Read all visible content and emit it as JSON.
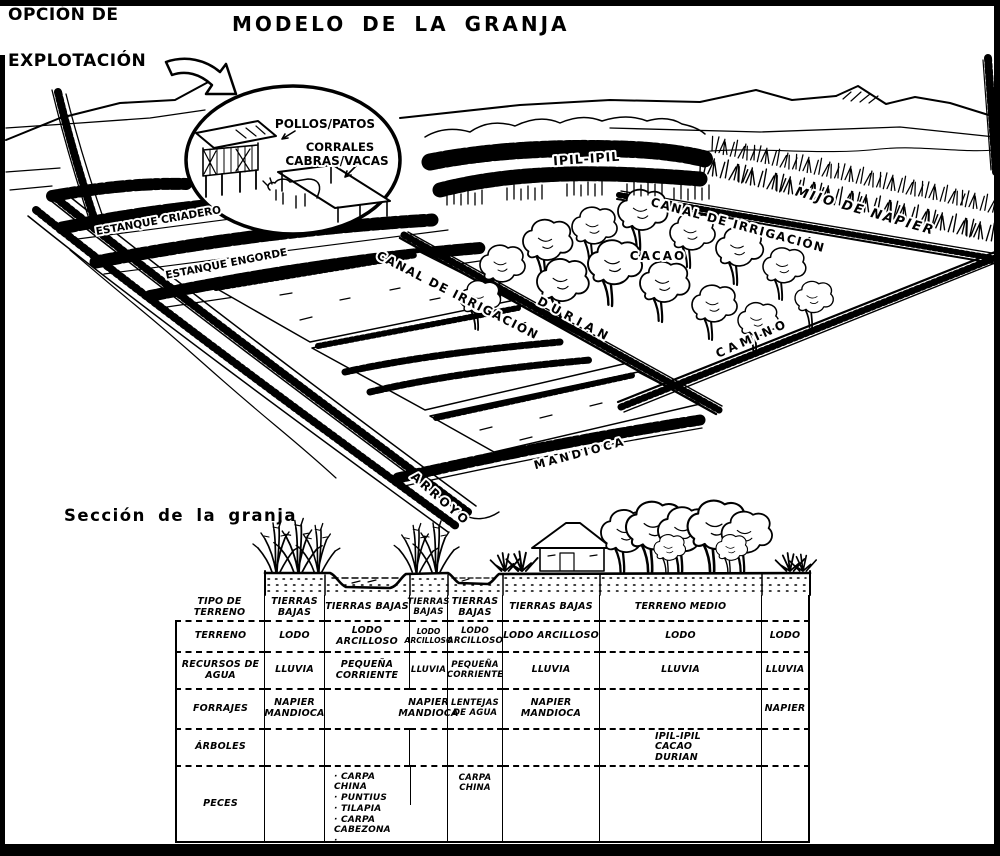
{
  "colors": {
    "ink": "#000000",
    "paper": "#ffffff"
  },
  "header": {
    "option_line1": "OPCIÓN DE",
    "option_line2": "EXPLOTACIÓN",
    "title": "MODELO DE LA GRANJA"
  },
  "inset": {
    "pollos_patos": "POLLOS/PATOS",
    "corrales": "CORRALES",
    "cabras_vacas": "CABRAS/VACAS"
  },
  "scene": {
    "estanque_criadero": "ESTANQUE CRIADERO",
    "estanque_engorde": "ESTANQUE ENGORDE",
    "ipil_ipil": "IPIL-IPIL",
    "canal_irrigacion_upper": "CANAL DE IRRIGACIÓN",
    "canal_irrigacion_lower": "CANAL DE IRRIGACIÓN",
    "mijo_de_napier": "MIJO DE NAPIER",
    "cacao": "CACAO",
    "durian": "DURIAN",
    "camino": "CAMINO",
    "mandioca": "MANDIOCA",
    "arroyo": "ARROYO"
  },
  "section": {
    "title": "Sección de la granja"
  },
  "table": {
    "row_headers": [
      "TIPO DE TERRENO",
      "TERRENO",
      "RECURSOS DE AGUA",
      "FORRAJES",
      "ÁRBOLES",
      "PECES"
    ],
    "header_cells": [
      "TIERRAS BAJAS",
      "TIERRAS BAJAS",
      "TIERRAS BAJAS",
      "TIERRAS BAJAS",
      "TIERRAS BAJAS",
      "TERRENO MEDIO",
      ""
    ],
    "terreno_cells": [
      "LODO",
      "LODO ARCILLOSO",
      "LODO ARCILLOSO",
      "LODO ARCILLOSO",
      "LODO ARCILLOSO",
      "LODO",
      "LODO"
    ],
    "agua_cells": [
      "LLUVIA",
      "PEQUEÑA CORRIENTE",
      "LLUVIA",
      "PEQUEÑA CORRIENTE",
      "LLUVIA",
      "LLUVIA",
      "LLUVIA"
    ],
    "forrajes_cells": [
      "NAPIER MANDIOCA",
      "",
      "NAPIER MANDIOCA",
      "LENTEJAS DE AGUA",
      "NAPIER MANDIOCA",
      "",
      "NAPIER"
    ],
    "arboles_col7": [
      "IPIL-IPIL",
      "CACAO",
      "DURIAN"
    ],
    "peces_col3": [
      "CARPA CHINA",
      "PUNTIUS",
      "TILAPIA",
      "CARPA CABEZONA",
      "LANGOSTINO DE AGUA DULCE"
    ],
    "peces_col5": "CARPA CHINA"
  }
}
